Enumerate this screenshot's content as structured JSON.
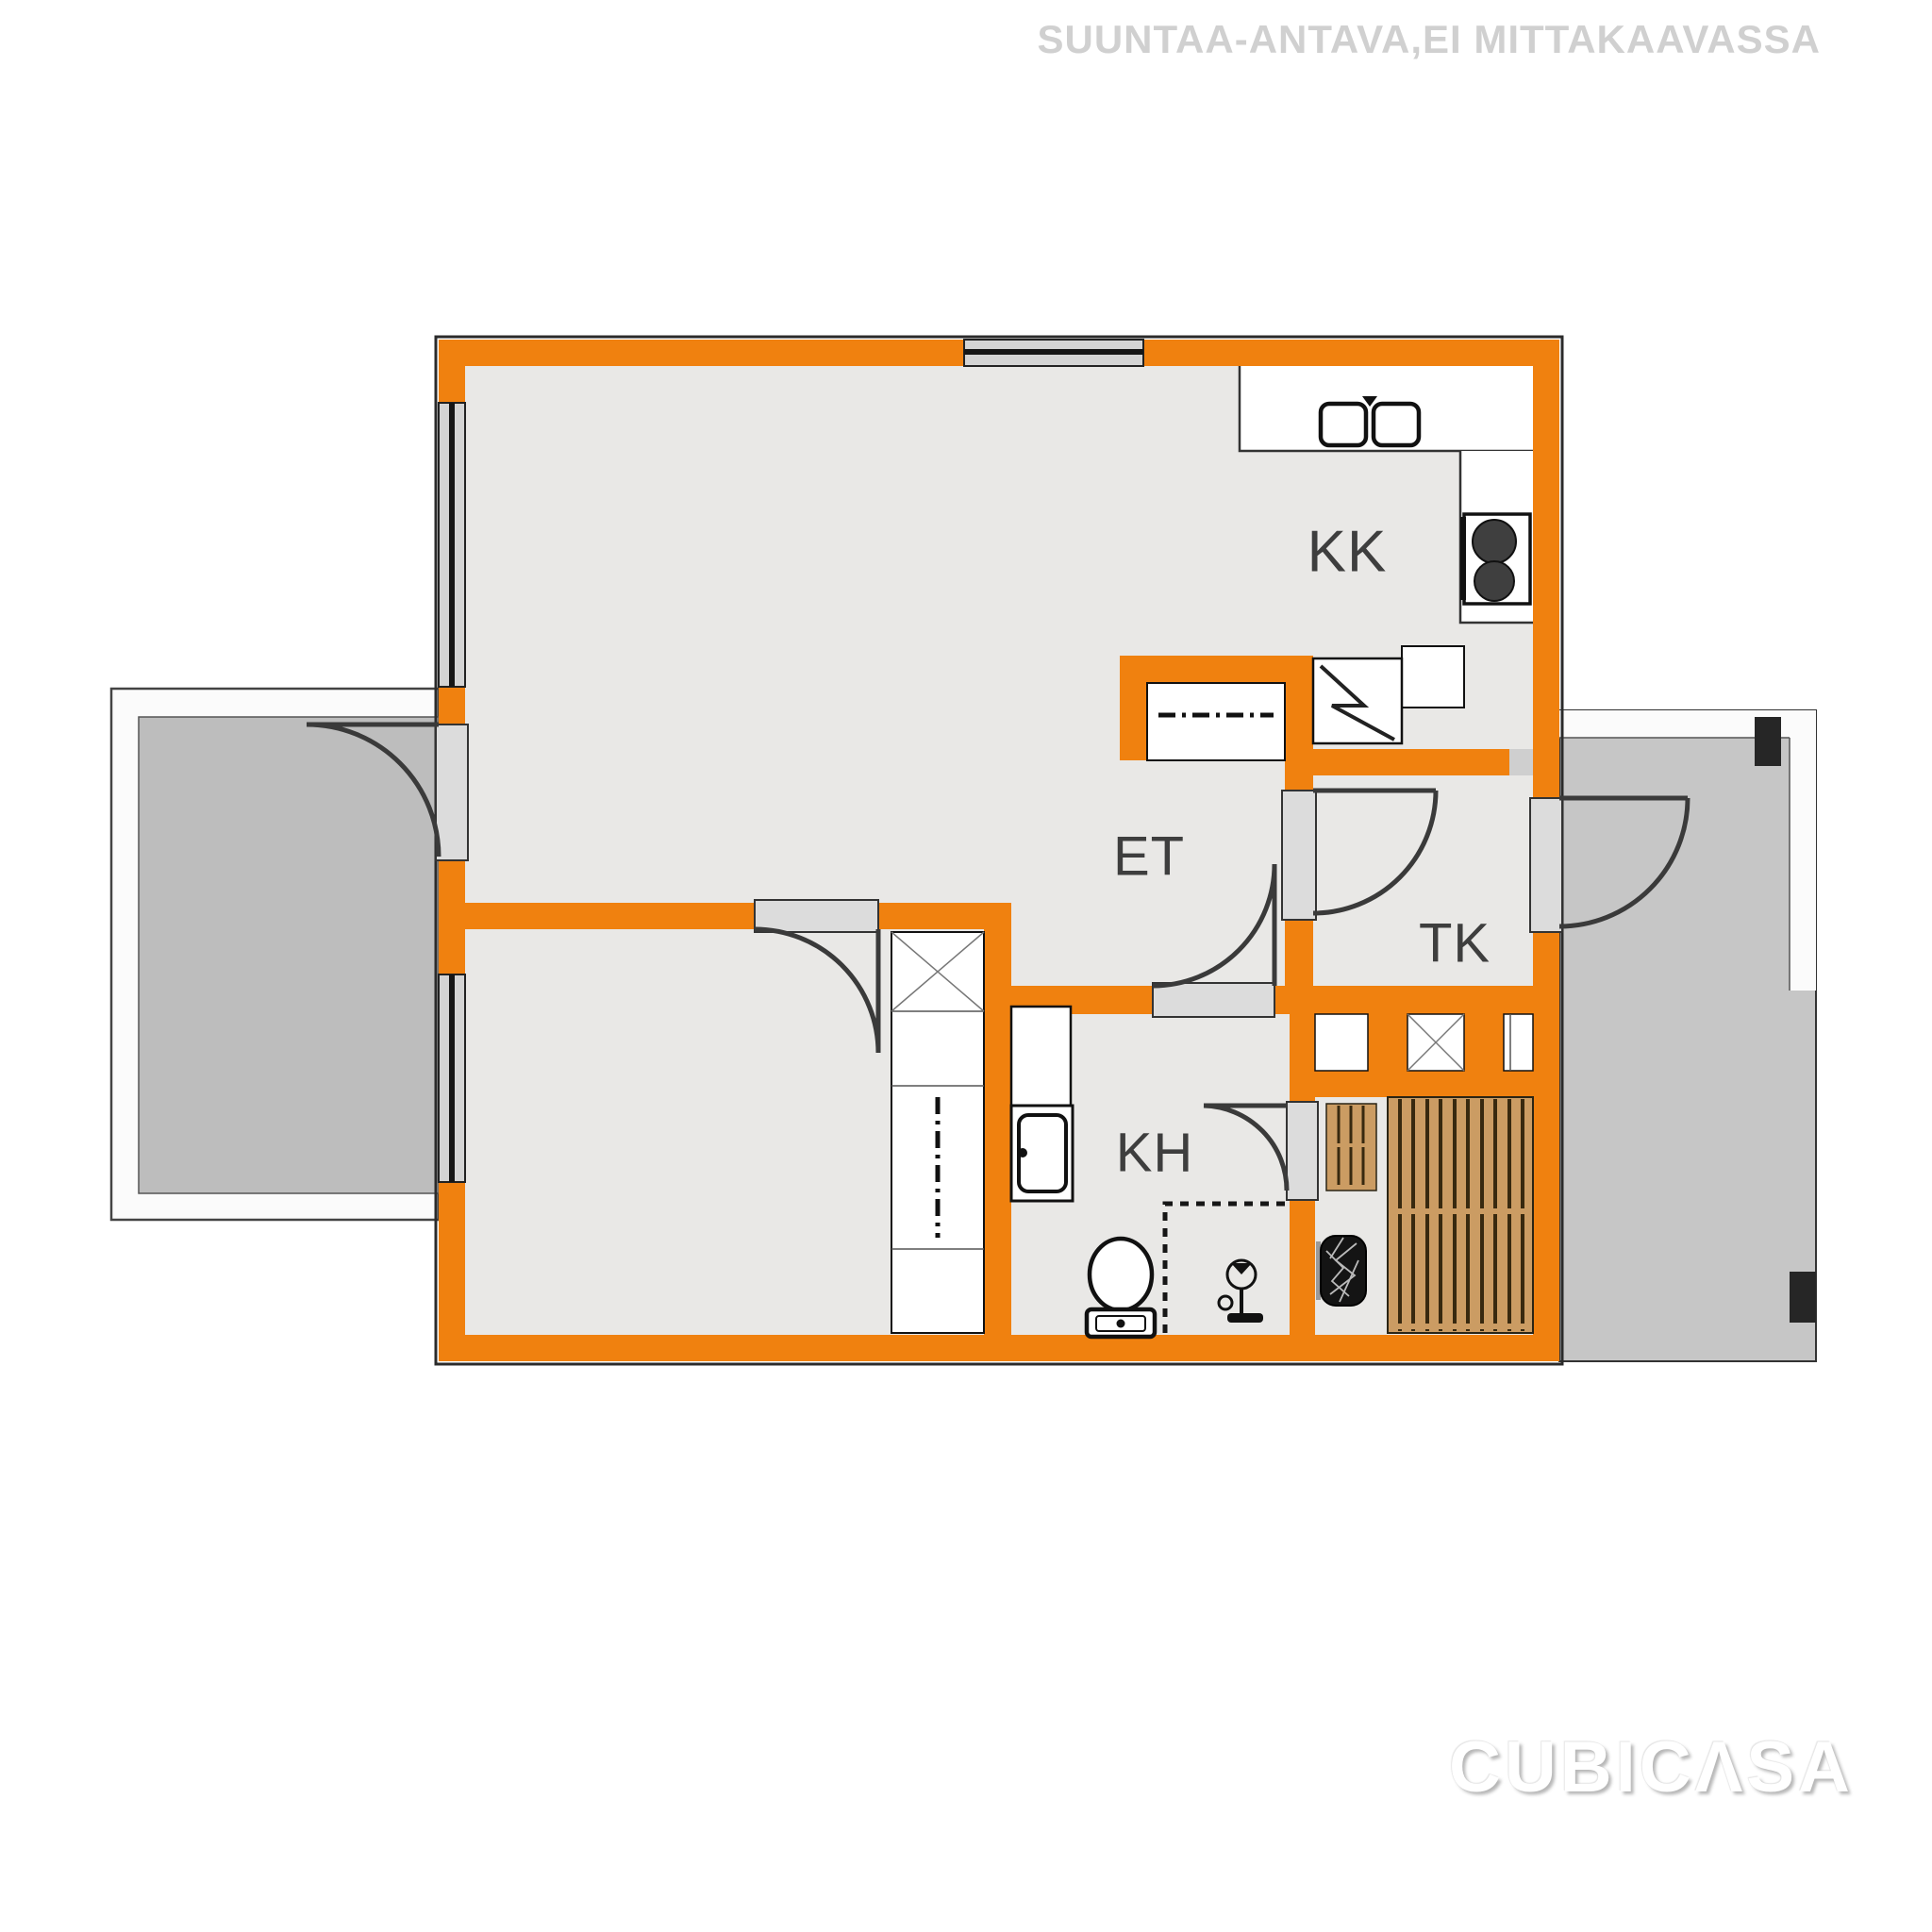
{
  "header": {
    "disclaimer": "SUUNTAA-ANTAVA,EI MITTAKAAVASSA"
  },
  "watermark": {
    "brand": "CUBICΛSA"
  },
  "rooms": {
    "kk": "KK",
    "et": "ET",
    "tk": "TK",
    "kh": "KH"
  },
  "colors": {
    "wall": "#F0810F",
    "floor": "#E9E8E6",
    "balcony_floor": "#BDBDBD",
    "terrace_floor": "#C6C6C6",
    "outside_trim": "#FBFBFB",
    "window_band": "#D4D4D4",
    "threshold": "#DCDCDC",
    "glass": "#161616",
    "line": "#333333",
    "wood": "#CB9C63",
    "wood_line": "#38290F",
    "label": "#3E3E3E",
    "disclaimer_text": "#D0D0D0",
    "watermark_text": "#FFFFFF",
    "mat": "#262626",
    "fixture_line": "#111111",
    "fixture_fill": "#FFFFFF"
  }
}
